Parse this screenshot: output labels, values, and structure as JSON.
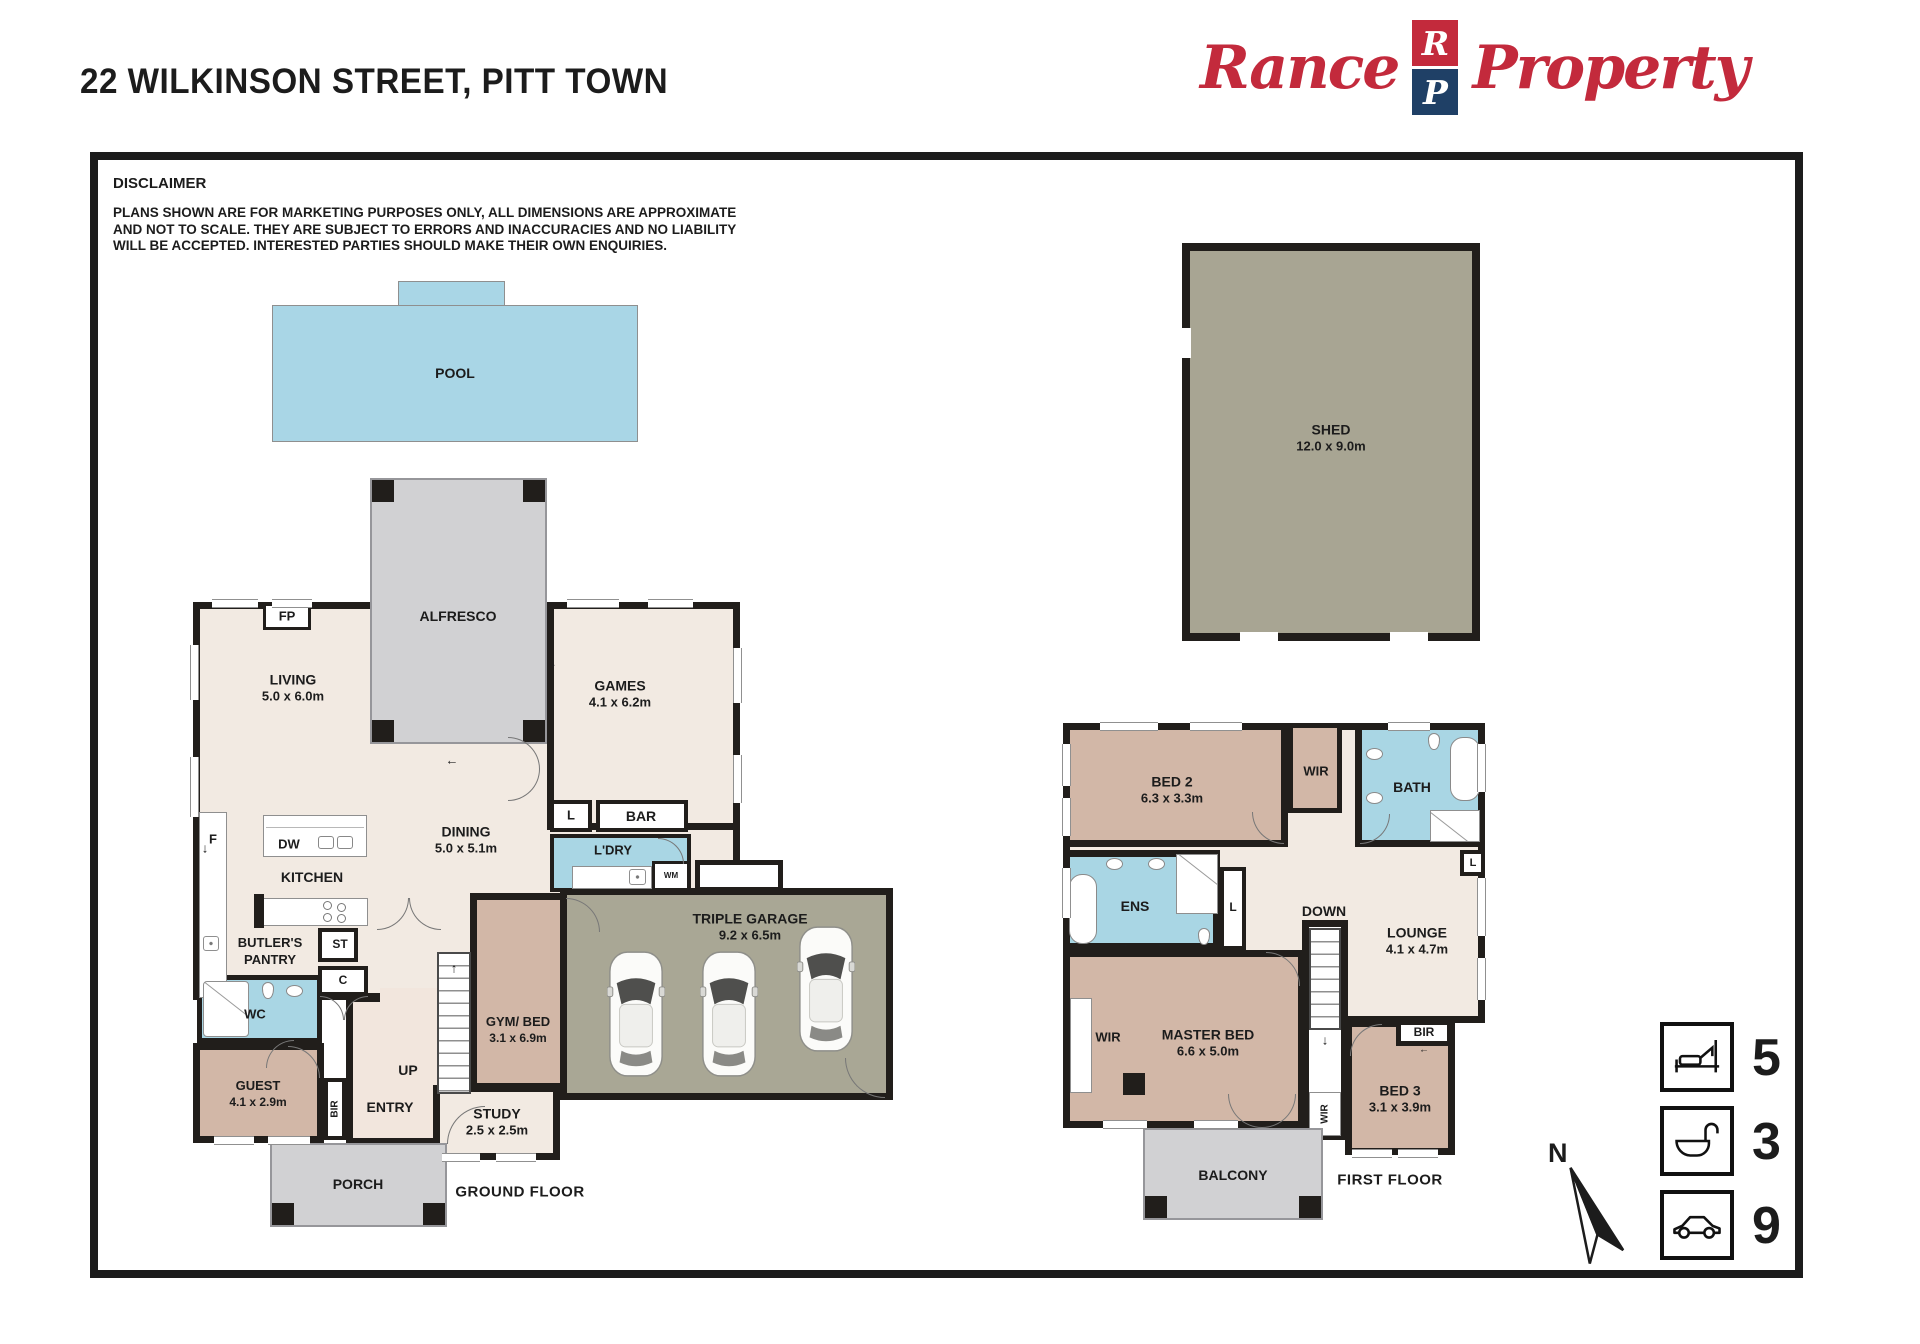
{
  "page": {
    "title": "22 WILKINSON STREET, PITT TOWN"
  },
  "logo": {
    "word1": "Rance",
    "word2": "Property",
    "mark_top": "R",
    "mark_bottom": "P"
  },
  "colors": {
    "brand_red": "#C32A3C",
    "brand_navy": "#1F4066",
    "wet_blue": "#A9D6E4",
    "bedroom_tan": "#D2B7A7",
    "outdoor_gray": "#D1D1D3",
    "garage_olive": "#A9A795"
  },
  "disclaimer": {
    "heading": "DISCLAIMER",
    "body": "PLANS SHOWN ARE FOR MARKETING PURPOSES ONLY, ALL DIMENSIONS ARE APPROXIMATE AND NOT TO SCALE. THEY ARE SUBJECT TO ERRORS AND INACCURACIES AND NO LIABILITY WILL BE ACCEPTED. INTERESTED PARTIES SHOULD MAKE THEIR OWN ENQUIRIES."
  },
  "floors": {
    "ground": "GROUND FLOOR",
    "first": "FIRST FLOOR"
  },
  "rooms": {
    "pool": {
      "label": "POOL"
    },
    "alfresco": {
      "label": "ALFRESCO"
    },
    "living": {
      "label": "LIVING",
      "dim": "5.0 x 6.0m"
    },
    "fp": {
      "label": "FP"
    },
    "games": {
      "label": "GAMES",
      "dim": "4.1 x 6.2m"
    },
    "dining": {
      "label": "DINING",
      "dim": "5.0 x 5.1m"
    },
    "kitchen": {
      "label": "KITCHEN"
    },
    "dw": {
      "label": "DW"
    },
    "fridge": {
      "label": "F"
    },
    "butlers": {
      "line1": "BUTLER'S",
      "line2": "PANTRY"
    },
    "st": {
      "label": "ST"
    },
    "c": {
      "label": "C"
    },
    "wc": {
      "label": "WC"
    },
    "guest": {
      "label": "GUEST",
      "dim": "4.1 x 2.9m"
    },
    "bir": {
      "label": "BIR"
    },
    "entry": {
      "label": "ENTRY"
    },
    "up": {
      "label": "UP"
    },
    "study": {
      "label": "STUDY",
      "dim": "2.5 x 2.5m"
    },
    "gym": {
      "label": "GYM/ BED",
      "dim": "3.1 x 6.9m"
    },
    "linen": {
      "label": "L"
    },
    "bar": {
      "label": "BAR"
    },
    "ldry": {
      "label": "L'DRY"
    },
    "wm": {
      "label": "WM"
    },
    "garage": {
      "label": "TRIPLE GARAGE",
      "dim": "9.2 x 6.5m"
    },
    "porch": {
      "label": "PORCH"
    },
    "shed": {
      "label": "SHED",
      "dim": "12.0 x 9.0m"
    },
    "bed2": {
      "label": "BED 2",
      "dim": "6.3 x 3.3m"
    },
    "wir": {
      "label": "WIR"
    },
    "bath": {
      "label": "BATH"
    },
    "ens": {
      "label": "ENS"
    },
    "down": {
      "label": "DOWN"
    },
    "lounge": {
      "label": "LOUNGE",
      "dim": "4.1 x 4.7m"
    },
    "master": {
      "label": "MASTER BED",
      "dim": "6.6 x 5.0m"
    },
    "bed3": {
      "label": "BED 3",
      "dim": "3.1 x 3.9m"
    },
    "balcony": {
      "label": "BALCONY"
    }
  },
  "legend": {
    "beds": "5",
    "baths": "3",
    "cars": "9"
  },
  "compass": {
    "north": "N"
  },
  "icons": {
    "up_arrow": "↑",
    "down_arrow": "↓",
    "left_arrow": "←",
    "right_arrow": "→"
  }
}
